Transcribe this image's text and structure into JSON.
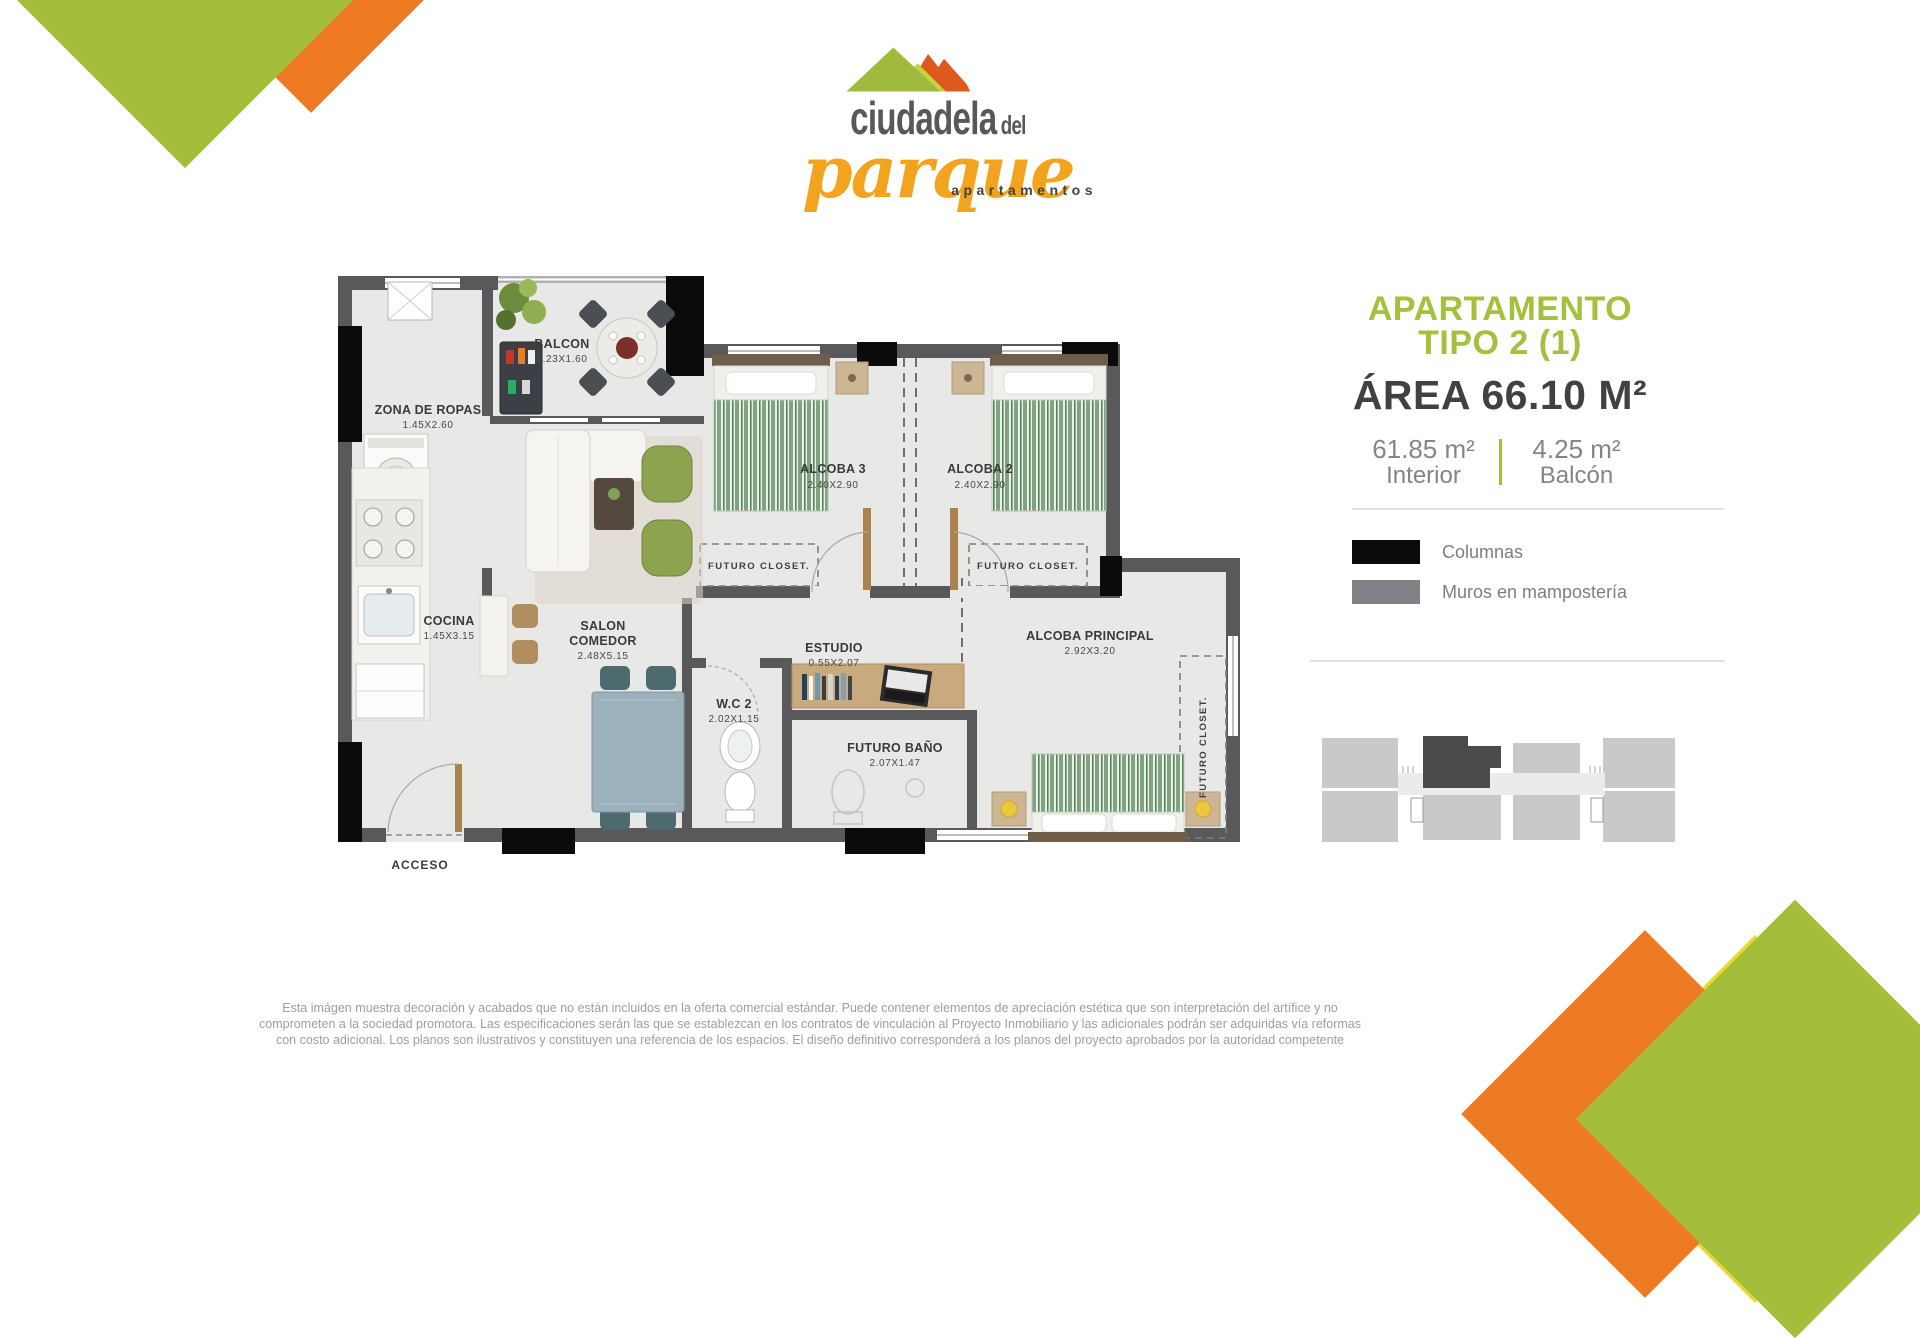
{
  "brand": {
    "word_top": "ciudadela",
    "word_top2": "del",
    "word_script": "parque",
    "tagline": "apartamentos"
  },
  "apartment": {
    "title_line1": "APARTAMENTO",
    "title_line2": "TIPO 2 (1)",
    "area_title": "ÁREA 66.10 M²",
    "breakdown": {
      "interior_value": "61.85 m²",
      "interior_label": "Interior",
      "balcony_value": "4.25 m²",
      "balcony_label": "Balcón"
    }
  },
  "legend": {
    "items": [
      {
        "label": "Columnas",
        "color": "#0b0b0b"
      },
      {
        "label": "Muros en mampostería",
        "color": "#808285"
      }
    ]
  },
  "floorplan": {
    "access_label": "ACCESO",
    "futuro_closet_label": "FUTURO CLOSET.",
    "rooms": [
      {
        "name": "ZONA DE ROPAS",
        "dims": "1.45X2.60"
      },
      {
        "name": "BALCON",
        "dims": "2.23X1.60"
      },
      {
        "name": "ALCOBA 3",
        "dims": "2.40X2.90"
      },
      {
        "name": "ALCOBA 2",
        "dims": "2.40X2.90"
      },
      {
        "name": "COCINA",
        "dims": "1.45X3.15"
      },
      {
        "name_line1": "SALON",
        "name_line2": "COMEDOR",
        "dims": "2.48X5.15"
      },
      {
        "name": "ESTUDIO",
        "dims": "0.55X2.07"
      },
      {
        "name": "W.C 2",
        "dims": "2.02X1.15"
      },
      {
        "name": "FUTURO BAÑO",
        "dims": "2.07X1.47"
      },
      {
        "name": "ALCOBA PRINCIPAL",
        "dims": "2.92X3.20"
      }
    ]
  },
  "disclaimer": {
    "line1": "Esta imágen muestra decoración y acabados que no están incluidos en la oferta comercial estándar. Puede contener elementos de apreciación estética que son interpretación del artífice y no",
    "line2": "comprometen a la sociedad promotora. Las especificaciones serán las que se establezcan en los contratos de vinculación al Proyecto Inmobiliario y las adicionales podrán ser adquiridas vía reformas",
    "line3": "con costo adicional. Los planos son ilustrativos y constituyen una referencia de los espacios. El diseño definitivo corresponderá a los planos del proyecto aprobados por la autoridad competente"
  },
  "colors": {
    "brand_green": "#a3c13c",
    "brand_orange": "#f3a41e",
    "corner_yellow": "#e7d929",
    "corner_orange": "#ee7a23",
    "corner_olive": "#a4bd3b",
    "wall_gray": "#59595c",
    "column_black": "#0b0b0b"
  }
}
